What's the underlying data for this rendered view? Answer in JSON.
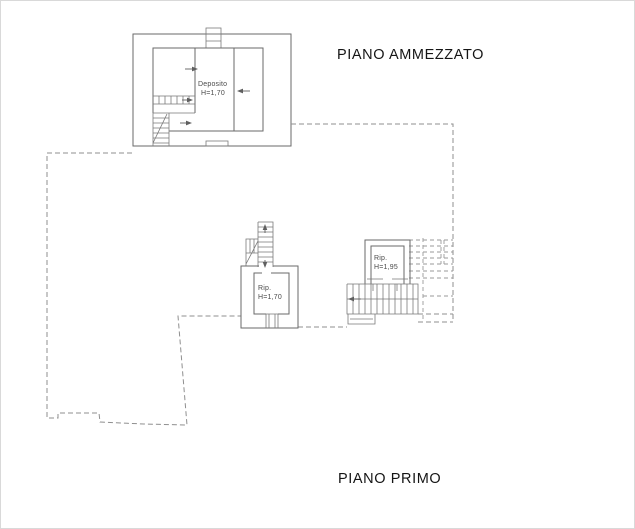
{
  "page": {
    "background": "#ffffff",
    "solid_line_color": "#6a6a6a",
    "dashed_line_color": "#8f8f8f",
    "title_text_color": "#151515",
    "label_text_color": "#4a4a4a"
  },
  "titles": {
    "mezzanine": "PIANO AMMEZZATO",
    "first_floor": "PIANO PRIMO"
  },
  "rooms": {
    "deposito": {
      "name": "Deposito",
      "height": "H=1,70"
    },
    "rip_middle": {
      "name": "Rip.",
      "height": "H=1,70"
    },
    "rip_right": {
      "name": "Rip.",
      "height": "H=1,95"
    }
  }
}
